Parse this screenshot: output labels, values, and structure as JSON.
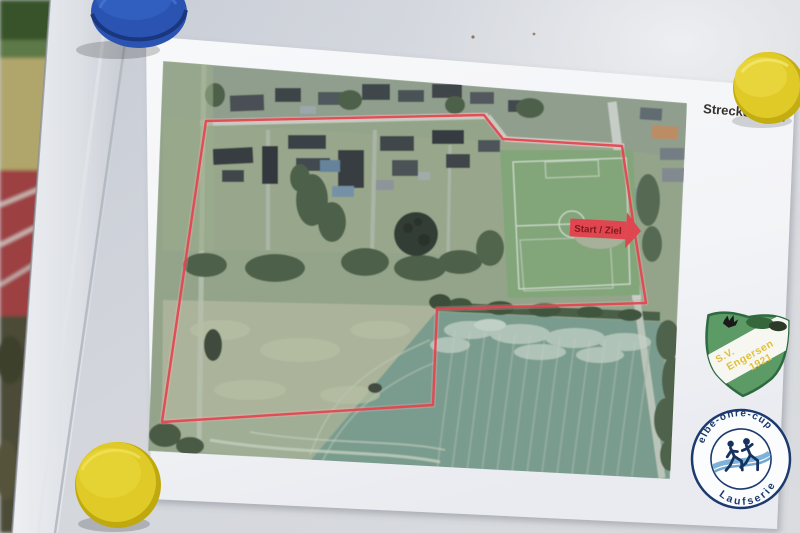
{
  "map_sheet": {
    "distance_label": "Strecke:",
    "distance_value": "1 km",
    "start_finish_label": "Start / Ziel"
  },
  "club_badge": {
    "abbreviation": "S.V.",
    "club_name": "Engersen",
    "founding_year": "1921"
  },
  "series_badge": {
    "arc_top": "elbe-ohre-cup",
    "arc_bottom": "Laufserie"
  },
  "colors": {
    "route": "#e2444e",
    "marker_fill": "#e0464f",
    "marker_text": "#7e1a1c",
    "badge_green": "#5c9a66",
    "badge_text_yellow": "#e3bf36",
    "series_navy": "#1c3a70",
    "series_wave": "#7fb2d8",
    "magnet_blue": "#2a53b2",
    "magnet_yellow": "#dfca28"
  }
}
